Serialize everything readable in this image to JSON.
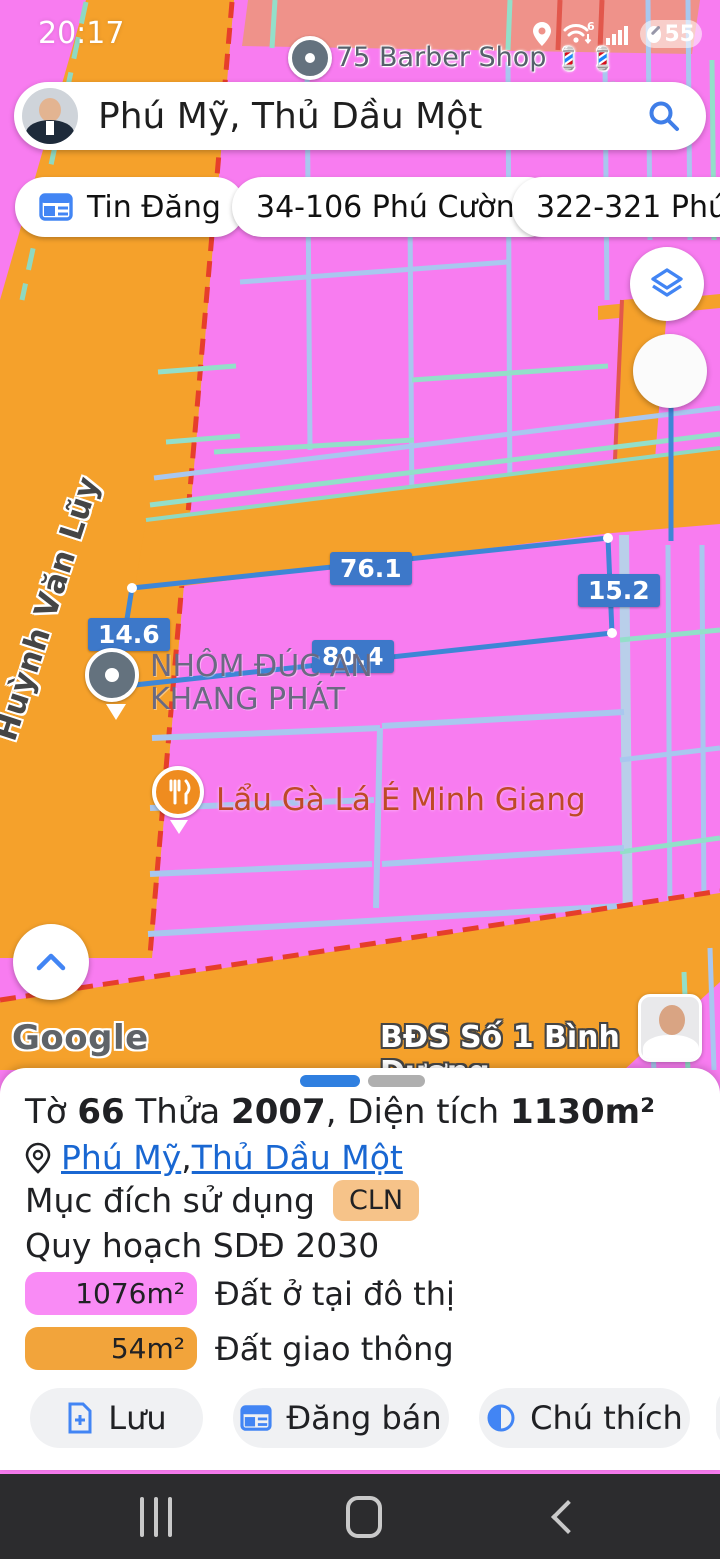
{
  "status_bar": {
    "time": "20:17",
    "battery_percent": "55"
  },
  "search": {
    "query": "Phú Mỹ, Thủ Dầu Một"
  },
  "chips": [
    {
      "label": "Tin Đăng"
    },
    {
      "label": "34-106 Phú Cường"
    },
    {
      "label": "322-321 Phú L"
    }
  ],
  "map": {
    "poi_barber": {
      "label": "75 Barber Shop",
      "emojis": "💈 💈"
    },
    "street_name": "Huỳnh Văn Lũy",
    "poi_business": {
      "line1": "NHÔM ĐÚC AN",
      "line2": "KHANG PHÁT"
    },
    "poi_restaurant": {
      "label": "Lẩu Gà Lá É Minh Giang"
    },
    "measurements": {
      "top": "76.1",
      "right": "15.2",
      "left": "14.6",
      "bottom": "80.4"
    },
    "google_logo": "Google",
    "watermark": "BĐS Số 1 Bình Dương"
  },
  "sheet": {
    "title": {
      "parts": [
        {
          "text": "Tờ "
        },
        {
          "text": "66"
        },
        {
          "text": " Thửa "
        },
        {
          "text": "2007"
        },
        {
          "text": ", Diện tích "
        },
        {
          "text": "1130m²"
        }
      ]
    },
    "location": {
      "link1": "Phú Mỹ",
      "separator": ", ",
      "link2": "Thủ Dầu Một"
    },
    "purpose_label": "Mục đích sử dụng",
    "purpose_badge": "CLN",
    "plan_label": "Quy hoạch SDĐ 2030",
    "legend": [
      {
        "area": "1076m²",
        "label": "Đất ở tại đô thị",
        "color": "#F98BF5"
      },
      {
        "area": "54m²",
        "label": "Đất giao thông",
        "color": "#F2A43B"
      }
    ],
    "buttons": [
      {
        "label": "Lưu"
      },
      {
        "label": "Đăng bán"
      },
      {
        "label": "Chú thích"
      }
    ]
  },
  "colors": {
    "zone_residential_pink": "#F87CF0",
    "zone_traffic_orange": "#F5A12B",
    "zone_salmon": "#EF928A",
    "parcel_teal": "#93DFC9",
    "parcel_blue": "#A9C7EF",
    "boundary_red": "#E63E2B",
    "measure_blue": "#3D78C9",
    "link_blue": "#1967D2",
    "icon_blue": "#4285F4"
  }
}
